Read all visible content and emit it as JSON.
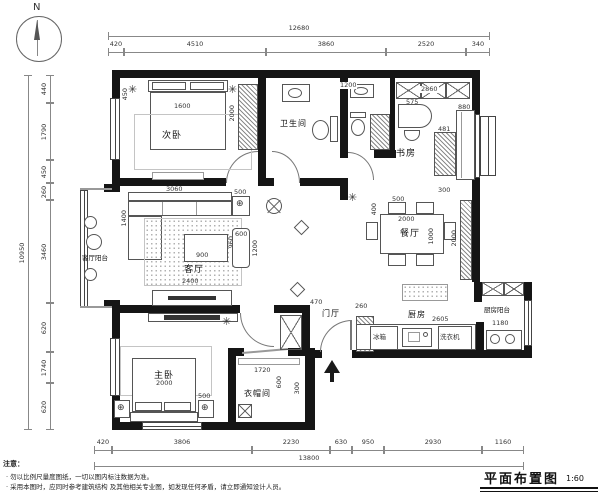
{
  "compass": {
    "label": "N"
  },
  "titleblock": {
    "title": "平面布置图",
    "scale": "1:60"
  },
  "notes": {
    "heading": "注意：",
    "lines": [
      "· 勿以比例尺量度图纸，一切以图内标注数据为准。",
      "· 采用本图时，应同时参考建筑结构 及其他相关专业图，如发现任何矛盾，请立即通知设计人员。"
    ]
  },
  "rooms": {
    "bedroom2": "次卧",
    "bath": "卫生间",
    "study": "书房",
    "living": "客厅",
    "living_balcony": "客厅阳台",
    "dining": "餐厅",
    "entry": "门厅",
    "kitchen": "厨房",
    "kitchen_balcony": "厨房阳台",
    "master": "主卧",
    "cloak": "衣帽间"
  },
  "appliances": {
    "fridge": "冰箱",
    "washer": "洗衣机"
  },
  "dims": {
    "top_total": "12680",
    "top": [
      "420",
      "4510",
      "3860",
      "2520",
      "340"
    ],
    "left_total": "10950",
    "left": [
      "440",
      "1790",
      "450",
      "260",
      "3460",
      "620",
      "1740",
      "620"
    ],
    "bottom": [
      "420",
      "3806",
      "2230",
      "630",
      "950",
      "2930",
      "1160"
    ],
    "bottom_total": "13800",
    "inner": {
      "bed2_width": "1600",
      "bed2_wardrobe": "2000",
      "bed2_side": "450",
      "wc_width": "1200",
      "study_closet": "2860",
      "desk": "575",
      "bookshelf": "481",
      "study_sofa": "880",
      "sofa_width": "3060",
      "sofa_depth": "1400",
      "sofa_side": "500",
      "coffee_table": "900",
      "coffee_depth": "960",
      "cabinet_width": "600",
      "cabinet_height": "1200",
      "rug_width": "2400",
      "dining_chair": "500",
      "dining_chair_depth": "400",
      "dining_table": "2000",
      "dining_table_depth": "1000",
      "dining_cabinet": "2000",
      "dining_cabinet_depth": "300",
      "entry_width": "470",
      "shoe_cabinet": "260",
      "kitchen_width": "2605",
      "kbalcony_width": "1180",
      "bed1_width": "2000",
      "nightstand": "500",
      "cloak_width": "1720",
      "cloak_depth": "600",
      "cloak_side": "300"
    }
  }
}
